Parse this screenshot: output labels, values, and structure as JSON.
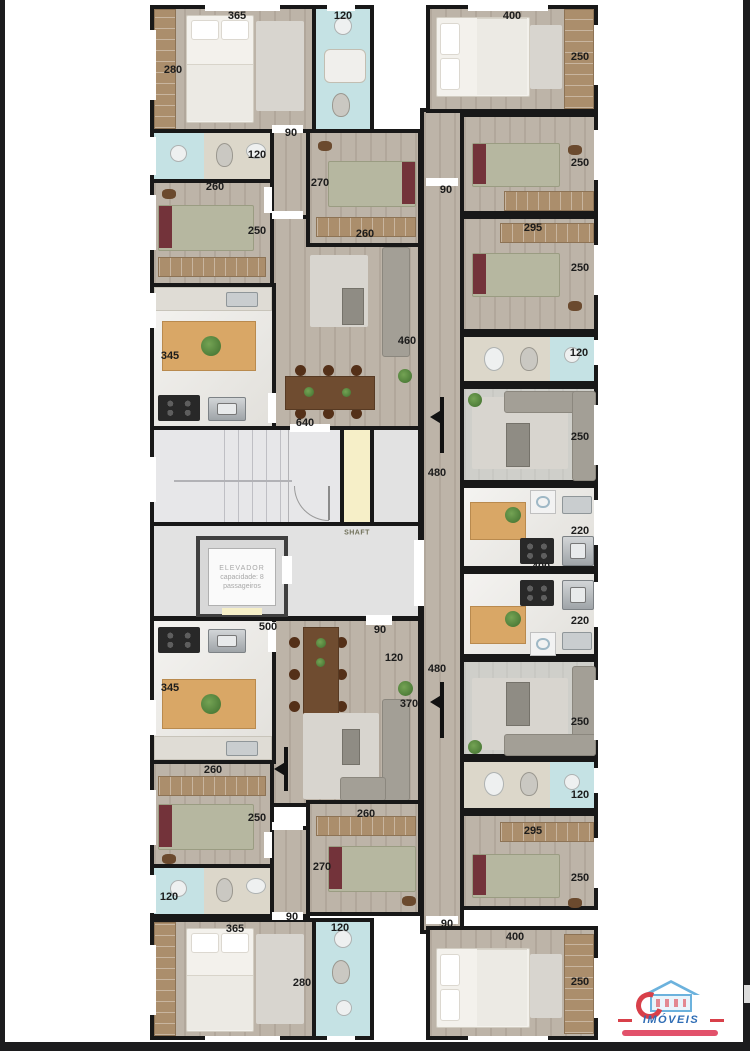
{
  "core": {
    "elevator_line1": "ELEVADOR",
    "elevator_line2": "capacidade: 8",
    "elevator_line3": "passageiros",
    "shaft_label": "SHAFT"
  },
  "logo": {
    "brand": "IMÓVEIS"
  },
  "colors": {
    "wall": "#181818",
    "wood_floor": "#bdb4a8",
    "bath_blue": "#c5e2e4",
    "tile": "#dcd7ca",
    "marble": "#e9e7e2",
    "stairs_gray": "#e7e7e9",
    "shaft_yellow": "#f6efc8",
    "landing_gray": "#e2e2e2",
    "single_bed": "#b6b7a0",
    "bed_headboard": "#73333a",
    "dining_table": "#6f4c30",
    "kitchen_table": "#d9a766",
    "logo_blue": "#2f6db5",
    "logo_red": "#d8404a"
  },
  "dimension_labels": [
    {
      "t": "365",
      "x": 237,
      "y": 16
    },
    {
      "t": "120",
      "x": 343,
      "y": 16
    },
    {
      "t": "280",
      "x": 173,
      "y": 70
    },
    {
      "t": "90",
      "x": 291,
      "y": 133
    },
    {
      "t": "120",
      "x": 257,
      "y": 155
    },
    {
      "t": "260",
      "x": 215,
      "y": 187
    },
    {
      "t": "250",
      "x": 257,
      "y": 231
    },
    {
      "t": "270",
      "x": 320,
      "y": 183
    },
    {
      "t": "260",
      "x": 365,
      "y": 234
    },
    {
      "t": "345",
      "x": 170,
      "y": 356
    },
    {
      "t": "460",
      "x": 407,
      "y": 341
    },
    {
      "t": "640",
      "x": 305,
      "y": 423
    },
    {
      "t": "500",
      "x": 268,
      "y": 627
    },
    {
      "t": "90",
      "x": 380,
      "y": 630
    },
    {
      "t": "120",
      "x": 394,
      "y": 658
    },
    {
      "t": "345",
      "x": 170,
      "y": 688
    },
    {
      "t": "370",
      "x": 409,
      "y": 704
    },
    {
      "t": "260",
      "x": 213,
      "y": 770
    },
    {
      "t": "250",
      "x": 257,
      "y": 818
    },
    {
      "t": "260",
      "x": 366,
      "y": 814
    },
    {
      "t": "270",
      "x": 322,
      "y": 867
    },
    {
      "t": "120",
      "x": 169,
      "y": 897
    },
    {
      "t": "90",
      "x": 292,
      "y": 917
    },
    {
      "t": "365",
      "x": 235,
      "y": 929
    },
    {
      "t": "120",
      "x": 340,
      "y": 928
    },
    {
      "t": "280",
      "x": 302,
      "y": 983
    },
    {
      "t": "400",
      "x": 512,
      "y": 16
    },
    {
      "t": "250",
      "x": 580,
      "y": 57
    },
    {
      "t": "250",
      "x": 580,
      "y": 163
    },
    {
      "t": "90",
      "x": 446,
      "y": 190
    },
    {
      "t": "295",
      "x": 533,
      "y": 228
    },
    {
      "t": "250",
      "x": 580,
      "y": 268
    },
    {
      "t": "120",
      "x": 579,
      "y": 353
    },
    {
      "t": "250",
      "x": 580,
      "y": 437
    },
    {
      "t": "480",
      "x": 437,
      "y": 473
    },
    {
      "t": "220",
      "x": 580,
      "y": 531
    },
    {
      "t": "400",
      "x": 541,
      "y": 567
    },
    {
      "t": "220",
      "x": 580,
      "y": 621
    },
    {
      "t": "480",
      "x": 437,
      "y": 669
    },
    {
      "t": "250",
      "x": 580,
      "y": 722
    },
    {
      "t": "120",
      "x": 580,
      "y": 795
    },
    {
      "t": "295",
      "x": 533,
      "y": 831
    },
    {
      "t": "250",
      "x": 580,
      "y": 878
    },
    {
      "t": "90",
      "x": 447,
      "y": 924
    },
    {
      "t": "400",
      "x": 515,
      "y": 937
    },
    {
      "t": "250",
      "x": 580,
      "y": 982
    }
  ]
}
